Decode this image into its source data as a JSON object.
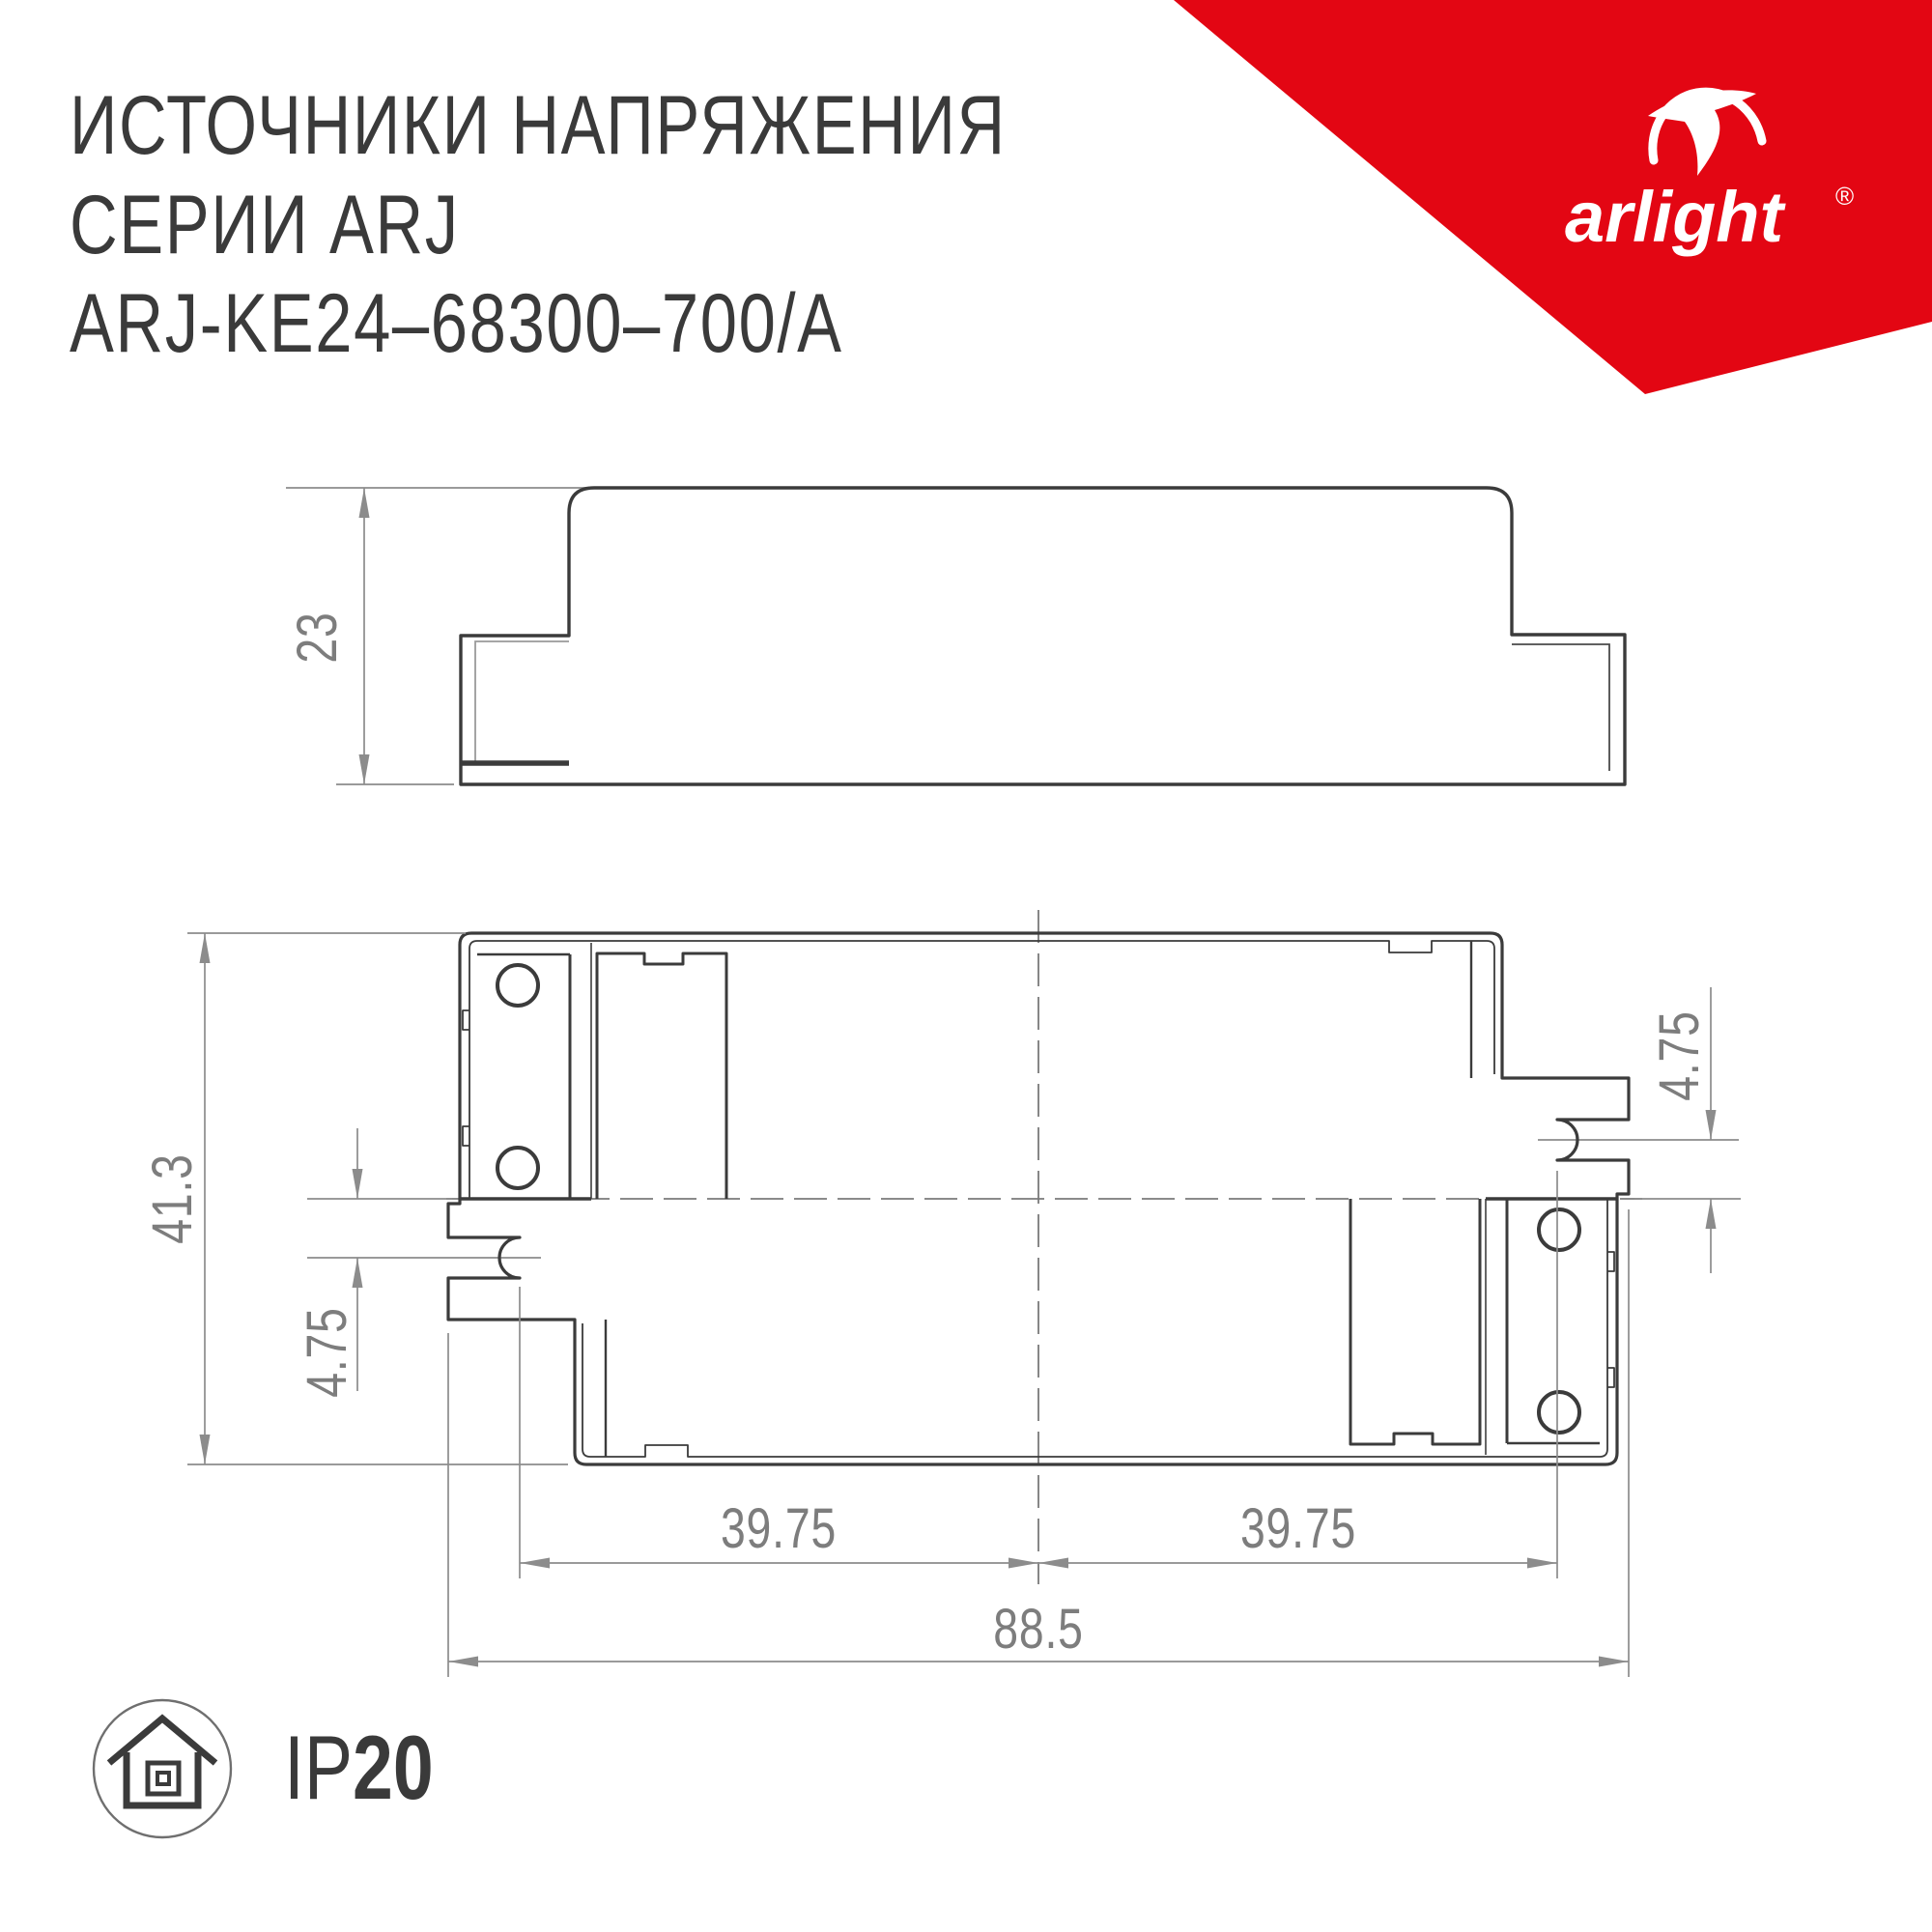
{
  "header": {
    "line1": "ИСТОЧНИКИ НАПРЯЖЕНИЯ",
    "line2": "СЕРИИ ARJ",
    "line3": "ARJ-KE24–68300–700/A"
  },
  "logo": {
    "brand": "arlight",
    "reg": "®",
    "swoosh_icon": "arlight-swoosh-icon",
    "banner_color": "#e30613"
  },
  "side_view": {
    "label_height": "23"
  },
  "top_view": {
    "label_height": "41.3",
    "label_slot_offset_left": "4.75",
    "label_slot_offset_right": "4.75",
    "label_center_to_slot_left": "39.75",
    "label_center_to_slot_right": "39.75",
    "label_overall_width": "88.5"
  },
  "footer": {
    "ip_prefix": "IP",
    "ip_value": "20",
    "ip_icon": "house-indoor-icon"
  },
  "colors": {
    "accent_red": "#e30613",
    "line_dark": "#3b3b3b",
    "dim_gray": "#8c8c8c",
    "text_gray": "#7d7d7d"
  }
}
